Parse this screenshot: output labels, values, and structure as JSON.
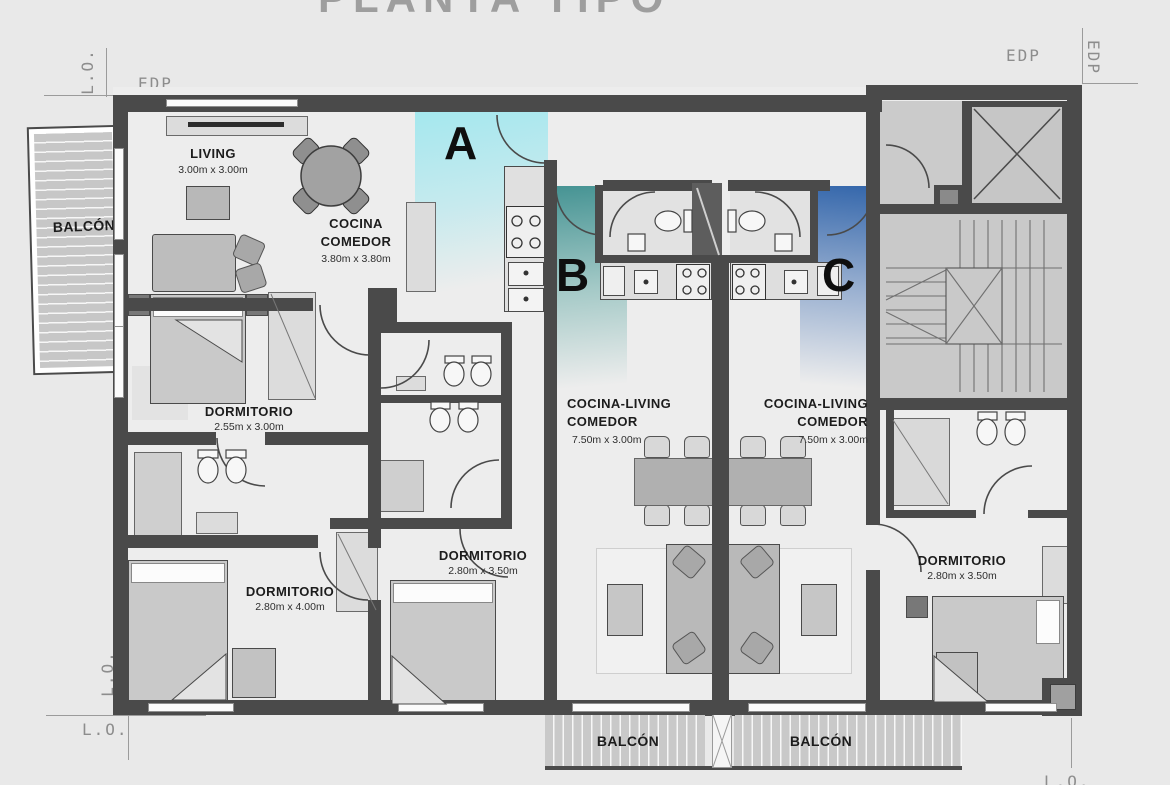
{
  "title": {
    "text": "PLANTA TIPO"
  },
  "reference": {
    "lo": "L.O.",
    "edp": "EDP"
  },
  "units": {
    "a": "A",
    "b": "B",
    "c": "C"
  },
  "rooms": {
    "living": {
      "name": "LIVING",
      "dims": "3.00m x 3.00m"
    },
    "cocina_comedor": {
      "line1": "COCINA",
      "line2": "COMEDOR",
      "dims": "3.80m x 3.80m"
    },
    "dormitorio_a1": {
      "name": "DORMITORIO",
      "dims": "2.55m x 3.00m"
    },
    "dormitorio_a2": {
      "name": "DORMITORIO",
      "dims": "2.80m x 4.00m"
    },
    "dormitorio_a3": {
      "name": "DORMITORIO",
      "dims": "2.80m x 3.50m"
    },
    "cocina_living_b": {
      "line1": "COCINA-LIVING",
      "line2": "COMEDOR",
      "dims": "7.50m x 3.00m"
    },
    "cocina_living_c": {
      "line1": "COCINA-LIVING",
      "line2": "COMEDOR",
      "dims": "7.50m x 3.00m"
    },
    "dormitorio_c": {
      "name": "DORMITORIO",
      "dims": "2.80m x 3.50m"
    },
    "balcon": {
      "name": "BALCÓN"
    }
  },
  "colors": {
    "background": "#e9e9e9",
    "floor": "#ededed",
    "wall": "#4a4a4a",
    "zone_a": "#a9e6ec",
    "zone_b": "#3f8e8d",
    "zone_c": "#2f5aa0",
    "stair_gray": "#c9c9c9",
    "label_dark": "#1c1c1c",
    "ref_gray": "#8d8d8d"
  }
}
